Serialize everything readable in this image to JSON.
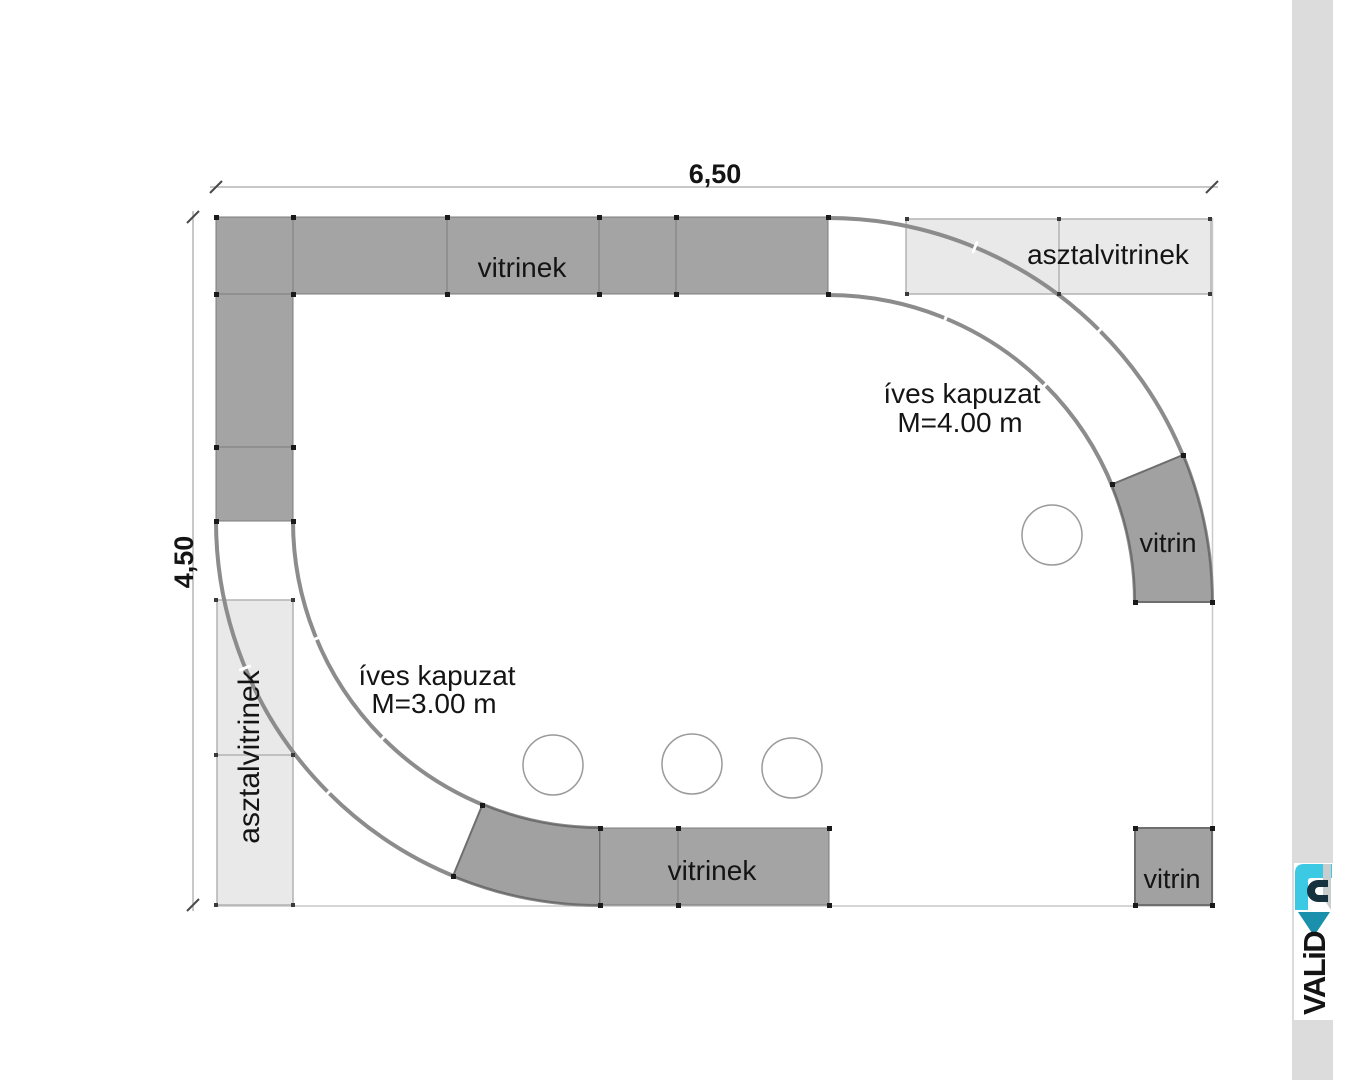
{
  "dims": {
    "width": "6,50",
    "height": "4,50"
  },
  "labels": {
    "top_vitrinek": "vitrinek",
    "bottom_vitrinek": "vitrinek",
    "asztalvitrinek_top": "asztalvitrinek",
    "asztalvitrinek_left": "asztalvitrinek",
    "vitrin_arc": "vitrin",
    "vitrin_corner": "vitrin"
  },
  "annotations": {
    "gateway_right": {
      "line1": "íves kapuzat",
      "line2": "M=4.00 m"
    },
    "gateway_left": {
      "line1": "íves kapuzat",
      "line2": "M=3.00 m"
    }
  },
  "logo": {
    "text": "VALiD"
  },
  "colors": {
    "display_case_gray": "#a4a4a4",
    "table_case_light": "#e9e9e9",
    "arc_stroke": "#8c8c8c",
    "sidebar_bar": "#dcdcdc",
    "logo_cyan": "#3cc9e4",
    "logo_teal": "#1b90ad",
    "logo_dark": "#16323e",
    "logo_gray": "#c9cdce"
  }
}
